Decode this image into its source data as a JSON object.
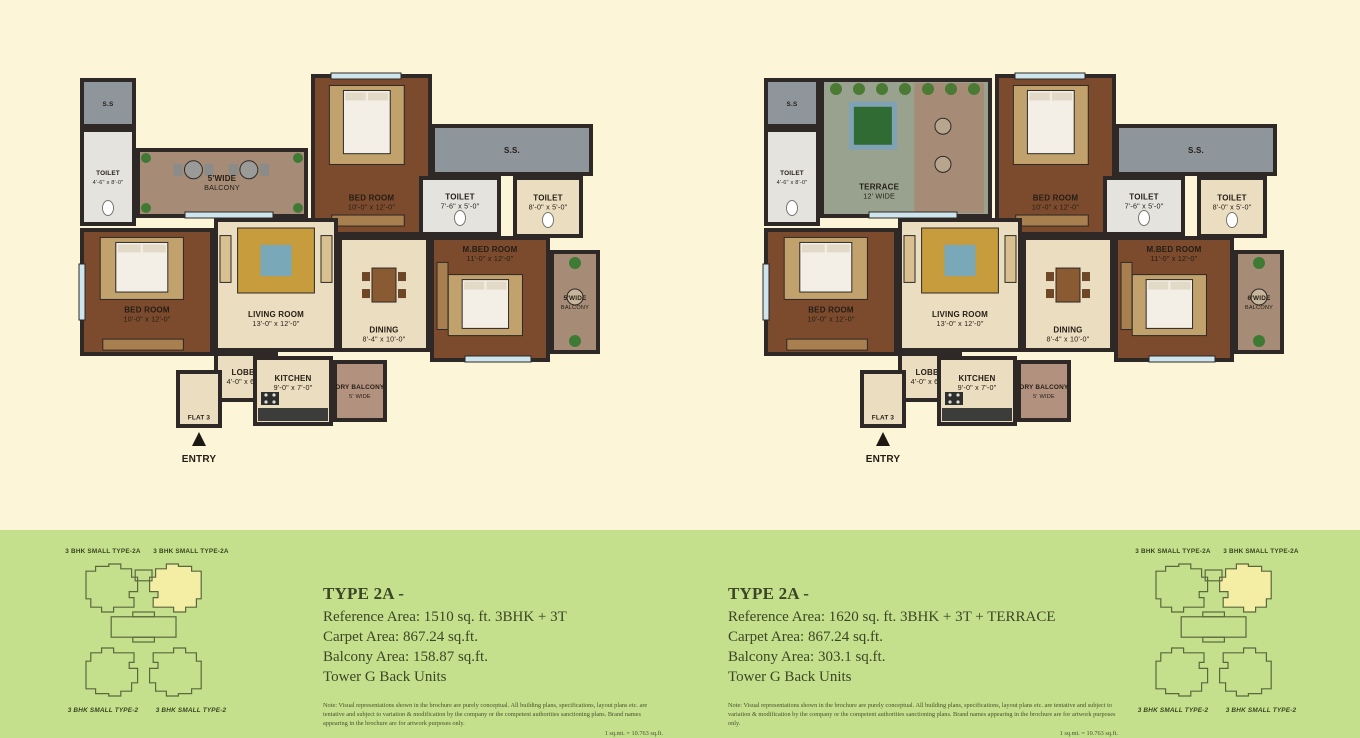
{
  "colors": {
    "bg_top": "#FCF5D8",
    "bg_bottom": "#C5E08D",
    "wall": "#2E2926",
    "wood": "#7C4B2D",
    "beige": "#EADDC0",
    "tile": "#E4E3DE",
    "shaft": "#8E959B",
    "balcony": "#A68C77",
    "terrace": "#99A28F",
    "dry": "#B2917F",
    "rug": "#C79C3C",
    "rug_center": "#79A8B8",
    "bed": "#F4EFE6",
    "tree": "#2F6B33",
    "tree_pad": "#7FA3B5",
    "table": "#8A5A33",
    "wardrobe": "#A87F4F",
    "window": "#CFE5EE",
    "label": "#241D15",
    "info_text": "#3C4526",
    "map_line": "#5A673C",
    "map_label": "#39441F",
    "highlight": "#F4EEA4"
  },
  "plans": [
    {
      "name": "floor-plan-left",
      "flat_label": "FLAT 3",
      "entry_label": "ENTRY",
      "rooms": [
        {
          "name": "shaft-ss-small",
          "label": "S.S",
          "x": 9,
          "y": 8,
          "w": 52,
          "h": 46,
          "fill": "shaft"
        },
        {
          "name": "toilet-small",
          "label": "TOILET",
          "dims": "4'-6\" x 8'-0\"",
          "x": 9,
          "y": 58,
          "w": 52,
          "h": 94,
          "fill": "tile",
          "deco": "wc"
        },
        {
          "name": "balcony-top",
          "label": "5'WIDE",
          "dims": "BALCONY",
          "x": 65,
          "y": 78,
          "w": 168,
          "h": 66,
          "fill": "balcony",
          "deco": "patio"
        },
        {
          "name": "bedroom-top",
          "label": "BED ROOM",
          "dims": "10'-0\" x 12'-0\"",
          "x": 240,
          "y": 4,
          "w": 117,
          "h": 158,
          "fill": "wood",
          "deco": "bed"
        },
        {
          "name": "shaft-ss-large",
          "label": "S.S.",
          "x": 360,
          "y": 54,
          "w": 158,
          "h": 48,
          "fill": "shaft"
        },
        {
          "name": "toilet-mid",
          "label": "TOILET",
          "dims": "7'-6\" x 5'-0\"",
          "x": 348,
          "y": 106,
          "w": 78,
          "h": 56,
          "fill": "tile",
          "deco": "wc"
        },
        {
          "name": "toilet-right",
          "label": "TOILET",
          "dims": "8'-0\" x 5'-0\"",
          "x": 442,
          "y": 106,
          "w": 66,
          "h": 58,
          "fill": "beige",
          "deco": "wc"
        },
        {
          "name": "bedroom-left",
          "label": "BED ROOM",
          "dims": "10'-0\" x 12'-0\"",
          "x": 9,
          "y": 158,
          "w": 130,
          "h": 124,
          "fill": "wood",
          "deco": "bed"
        },
        {
          "name": "living-room",
          "label": "LIVING ROOM",
          "dims": "13'-0\" x 12'-0\"",
          "x": 143,
          "y": 148,
          "w": 120,
          "h": 130,
          "fill": "beige",
          "deco": "rug"
        },
        {
          "name": "lobby",
          "label": "LOBBY",
          "dims": "4'-0\" x 6'-3\"",
          "x": 143,
          "y": 282,
          "w": 60,
          "h": 46,
          "fill": "beige"
        },
        {
          "name": "dining",
          "label": "DINING",
          "dims": "8'-4\" x 10'-0\"",
          "x": 267,
          "y": 166,
          "w": 88,
          "h": 112,
          "fill": "beige",
          "deco": "table"
        },
        {
          "name": "master-bedroom",
          "label": "M.BED ROOM",
          "dims": "11'-0\" x 12'-0\"",
          "x": 359,
          "y": 166,
          "w": 116,
          "h": 122,
          "fill": "wood",
          "deco": "bed"
        },
        {
          "name": "side-balcony",
          "label": "5'WIDE",
          "dims": "BALCONY",
          "x": 479,
          "y": 180,
          "w": 46,
          "h": 100,
          "fill": "balcony",
          "deco": "plants"
        },
        {
          "name": "kitchen",
          "label": "KITCHEN",
          "dims": "9'-0\" x 7'-0\"",
          "x": 182,
          "y": 286,
          "w": 76,
          "h": 66,
          "fill": "beige",
          "deco": "counter"
        },
        {
          "name": "dry-balcony",
          "label": "DRY BALCONY",
          "dims": "5' WIDE",
          "x": 262,
          "y": 290,
          "w": 50,
          "h": 58,
          "fill": "dry"
        },
        {
          "name": "entry-hall",
          "label": "FLAT 3",
          "x": 105,
          "y": 300,
          "w": 42,
          "h": 54,
          "fill": "beige"
        }
      ]
    },
    {
      "name": "floor-plan-right",
      "flat_label": "FLAT 3",
      "entry_label": "ENTRY",
      "rooms": [
        {
          "name": "shaft-ss-small",
          "label": "S.S",
          "x": 9,
          "y": 8,
          "w": 52,
          "h": 46,
          "fill": "shaft"
        },
        {
          "name": "toilet-small",
          "label": "TOILET",
          "dims": "4'-6\" x 8'-0\"",
          "x": 9,
          "y": 58,
          "w": 52,
          "h": 94,
          "fill": "tile",
          "deco": "wc"
        },
        {
          "name": "terrace",
          "label": "TERRACE",
          "dims": "12' WIDE",
          "x": 65,
          "y": 8,
          "w": 168,
          "h": 136,
          "fill": "terrace",
          "deco": "tree"
        },
        {
          "name": "bedroom-top",
          "label": "BED ROOM",
          "dims": "10'-0\" x 12'-0\"",
          "x": 240,
          "y": 4,
          "w": 117,
          "h": 158,
          "fill": "wood",
          "deco": "bed"
        },
        {
          "name": "shaft-ss-large",
          "label": "S.S.",
          "x": 360,
          "y": 54,
          "w": 158,
          "h": 48,
          "fill": "shaft"
        },
        {
          "name": "toilet-mid",
          "label": "TOILET",
          "dims": "7'-6\" x 5'-0\"",
          "x": 348,
          "y": 106,
          "w": 78,
          "h": 56,
          "fill": "tile",
          "deco": "wc"
        },
        {
          "name": "toilet-right",
          "label": "TOILET",
          "dims": "8'-0\" x 5'-0\"",
          "x": 442,
          "y": 106,
          "w": 66,
          "h": 58,
          "fill": "beige",
          "deco": "wc"
        },
        {
          "name": "bedroom-left",
          "label": "BED ROOM",
          "dims": "10'-0\" x 12'-0\"",
          "x": 9,
          "y": 158,
          "w": 130,
          "h": 124,
          "fill": "wood",
          "deco": "bed"
        },
        {
          "name": "living-room",
          "label": "LIVING ROOM",
          "dims": "13'-0\" x 12'-0\"",
          "x": 143,
          "y": 148,
          "w": 120,
          "h": 130,
          "fill": "beige",
          "deco": "rug"
        },
        {
          "name": "lobby",
          "label": "LOBBY",
          "dims": "4'-0\" x 6'-3\"",
          "x": 143,
          "y": 282,
          "w": 60,
          "h": 46,
          "fill": "beige"
        },
        {
          "name": "dining",
          "label": "DINING",
          "dims": "8'-4\" x 10'-0\"",
          "x": 267,
          "y": 166,
          "w": 88,
          "h": 112,
          "fill": "beige",
          "deco": "table"
        },
        {
          "name": "master-bedroom",
          "label": "M.BED ROOM",
          "dims": "11'-0\" x 12'-0\"",
          "x": 359,
          "y": 166,
          "w": 116,
          "h": 122,
          "fill": "wood",
          "deco": "bed"
        },
        {
          "name": "side-balcony",
          "label": "6'WIDE",
          "dims": "BALCONY",
          "x": 479,
          "y": 180,
          "w": 46,
          "h": 100,
          "fill": "balcony",
          "deco": "plants"
        },
        {
          "name": "kitchen",
          "label": "KITCHEN",
          "dims": "9'-0\" x 7'-0\"",
          "x": 182,
          "y": 286,
          "w": 76,
          "h": 66,
          "fill": "beige",
          "deco": "counter"
        },
        {
          "name": "dry-balcony",
          "label": "DRY BALCONY",
          "dims": "5' WIDE",
          "x": 262,
          "y": 290,
          "w": 50,
          "h": 58,
          "fill": "dry"
        },
        {
          "name": "entry-hall",
          "label": "FLAT 3",
          "x": 105,
          "y": 300,
          "w": 42,
          "h": 54,
          "fill": "beige"
        }
      ]
    }
  ],
  "info_blocks": [
    {
      "title": "TYPE 2A -",
      "lines": [
        "Reference Area: 1510 sq. ft. 3BHK + 3T",
        "Carpet Area: 867.24 sq.ft.",
        "Balcony Area: 158.87 sq.ft.",
        "Tower G Back Units"
      ],
      "note": "Note: Visual representations shown in the brochure are purely conceptual. All building plans, specifications, layout plans etc. are tentative and subject to variation & modification by the company or the competent authorities sanctioning plans. Brand names appearing in the brochure are for artwork purposes only.",
      "conversion": "1 sq.mt. = 10.763 sq.ft."
    },
    {
      "title": "TYPE 2A -",
      "lines": [
        "Reference Area: 1620 sq. ft. 3BHK + 3T + TERRACE",
        "Carpet Area: 867.24 sq.ft.",
        "Balcony Area: 303.1 sq.ft.",
        "Tower G Back Units"
      ],
      "note": "Note: Visual representations shown in the brochure are purely conceptual. All building plans, specifications, layout plans etc. are tentative and subject to variation & modification by the company or the competent authorities sanctioning plans. Brand names appearing in the brochure are for artwork purposes only.",
      "conversion": "1 sq.mt. = 10.763 sq.ft."
    }
  ],
  "site_maps": [
    {
      "top_labels": [
        "3 BHK SMALL TYPE-2A",
        "3 BHK SMALL TYPE-2A"
      ],
      "bottom_labels": [
        "3 BHK SMALL TYPE-2",
        "3 BHK SMALL TYPE-2"
      ]
    },
    {
      "top_labels": [
        "3 BHK SMALL TYPE-2A",
        "3 BHK SMALL TYPE-2A"
      ],
      "bottom_labels": [
        "3 BHK SMALL TYPE-2",
        "3 BHK SMALL TYPE-2"
      ]
    }
  ]
}
